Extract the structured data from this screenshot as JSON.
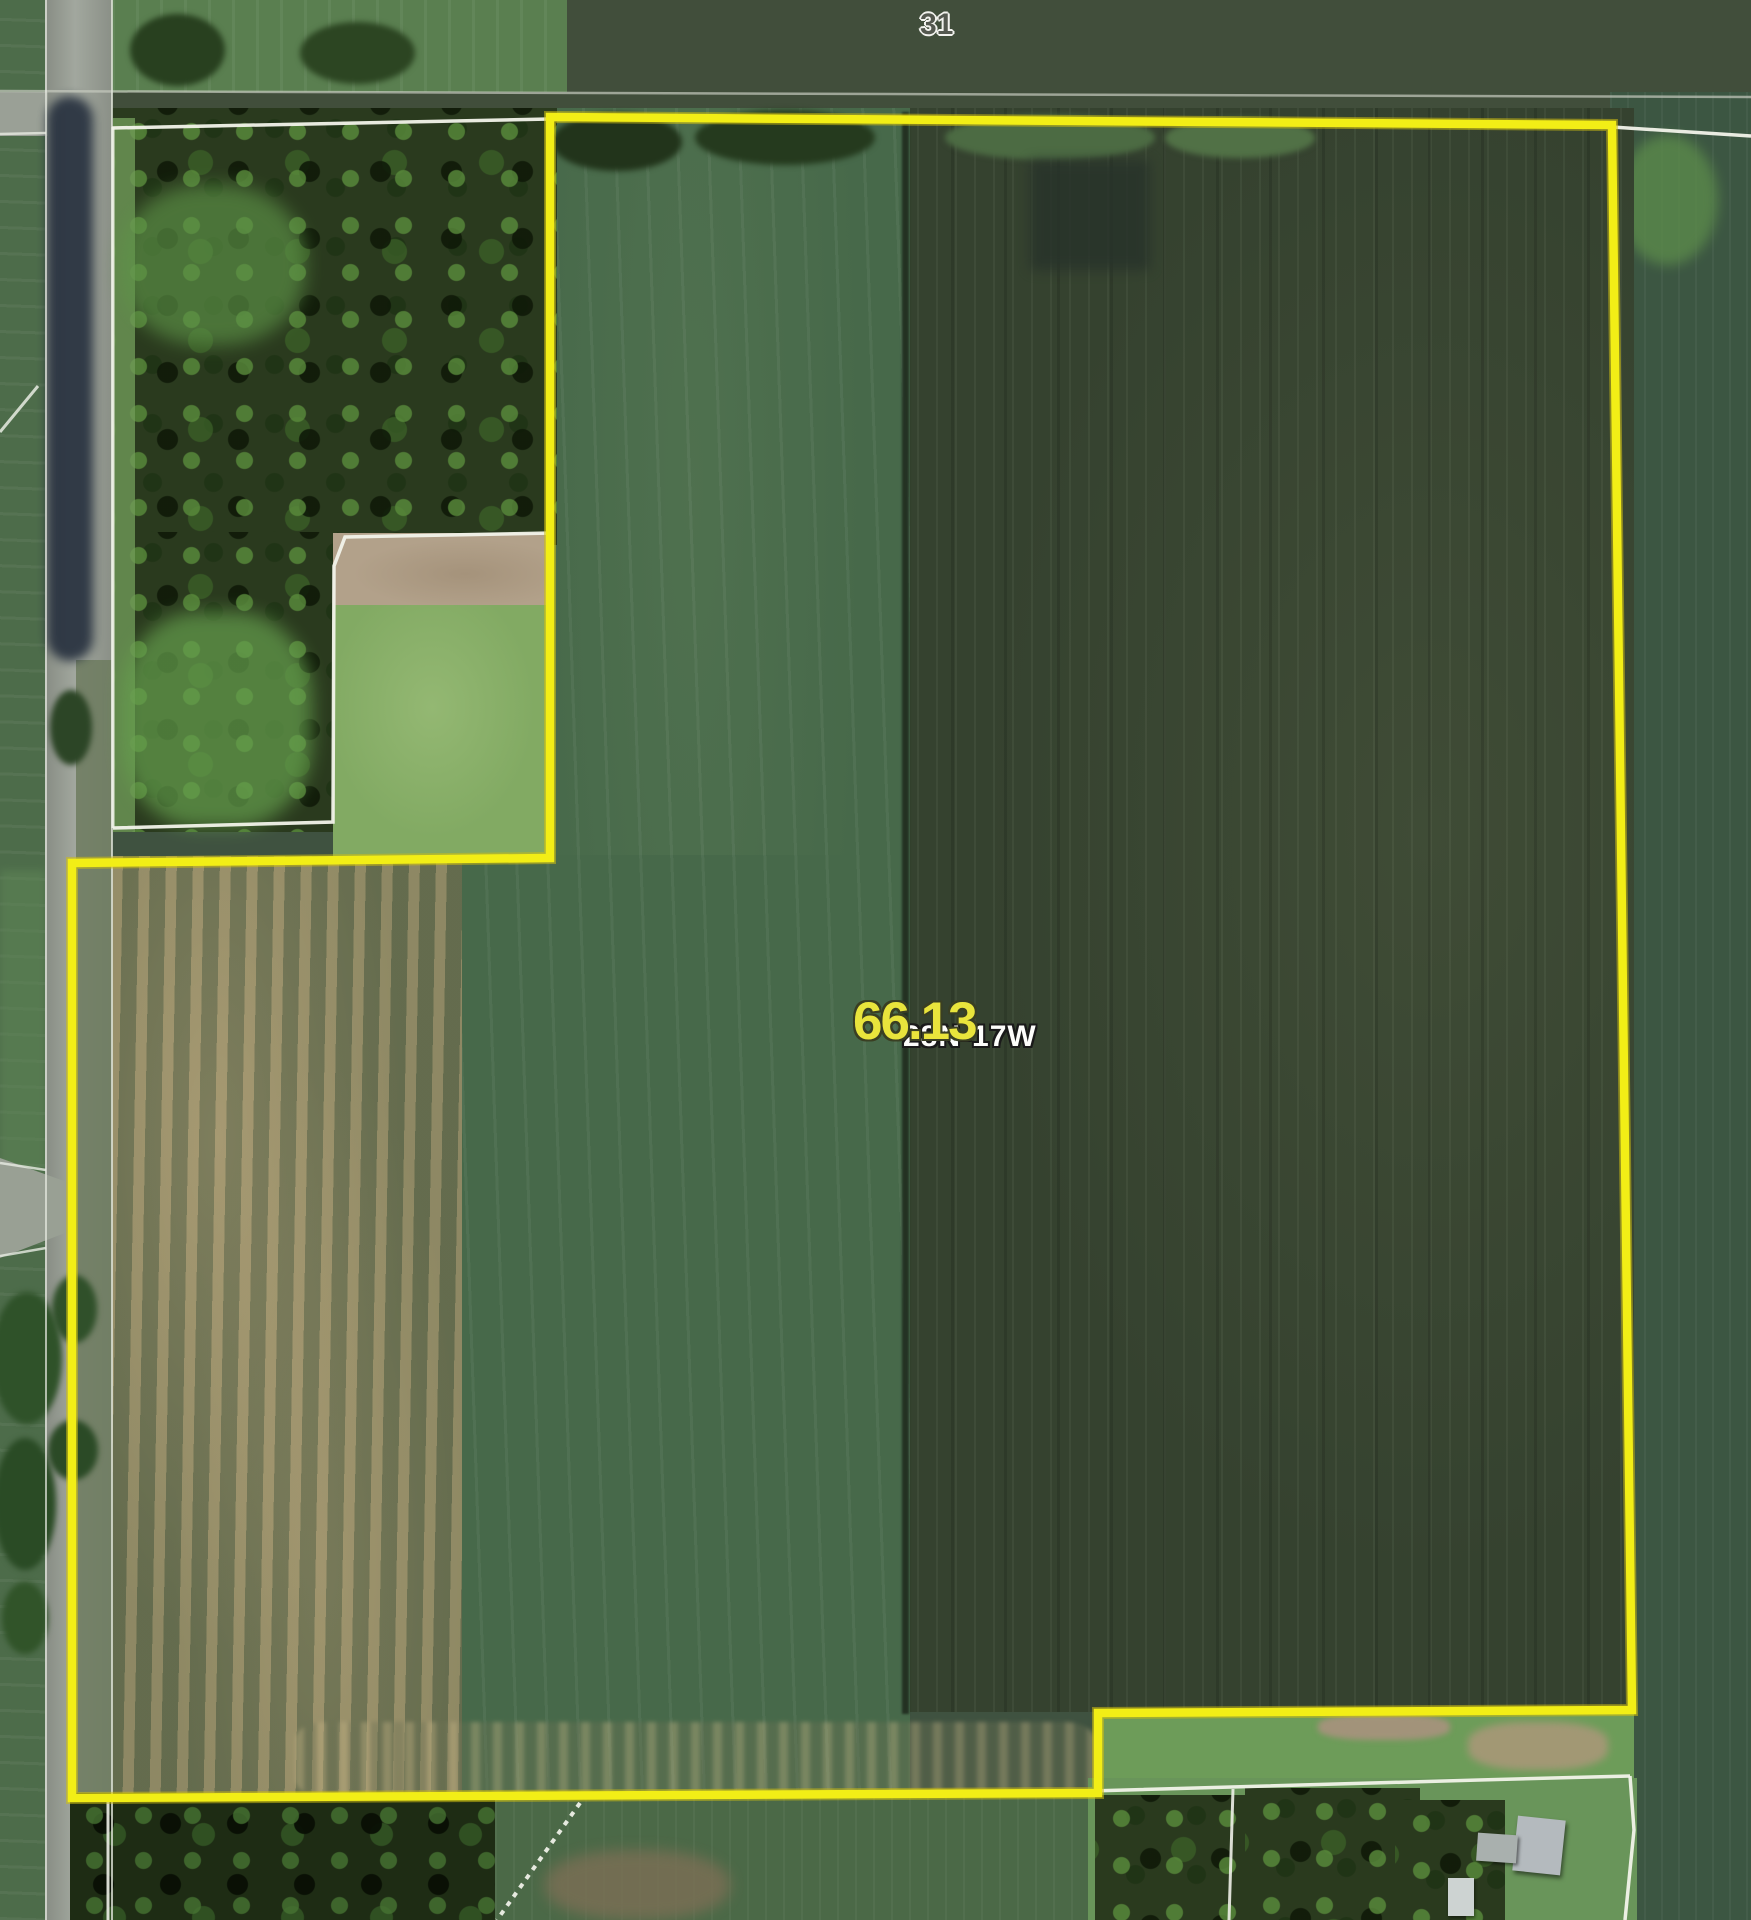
{
  "map": {
    "section_number": "31",
    "parcel": {
      "acreage": "66.13",
      "township_range": "28N-17W"
    },
    "colors": {
      "parcel_boundary_yellow": "#f2ee16",
      "neighbor_boundary_white": "#f2f3ea",
      "section_line_gray": "#c6cabf",
      "acreage_text_yellow": "#e9e43c",
      "section_text_gray": "#54584f",
      "township_text_white": "#fdfdfb"
    }
  }
}
